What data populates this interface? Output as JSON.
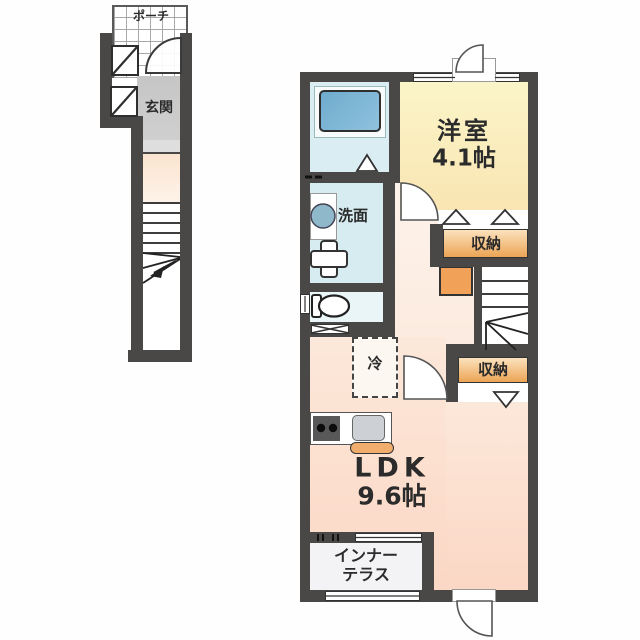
{
  "title": "apartment floor plan",
  "labels": {
    "porch": "ポーチ",
    "entrance": "玄関",
    "western_room": "洋室",
    "western_room_size": "4.1帖",
    "storage_upper": "収納",
    "storage_lower": "収納",
    "washroom": "洗面",
    "fridge": "冷",
    "ldk": "LDK",
    "ldk_size": "9.6帖",
    "terrace_line1": "インナー",
    "terrace_line2": "テラス"
  },
  "colors": {
    "wall": "#4a4846",
    "bath": "#d9edf2",
    "tub": "#7cb5d7",
    "yellow": "#fbf5c8",
    "yellow2": "#f9e5b2",
    "cream": "#fdf3ea",
    "cream2": "#fbe7d8",
    "pink": "#fce8da",
    "pink2": "#fbd7c5",
    "orange": "#eca455",
    "orange_light": "#fbe2bd",
    "accent": "#f1a258",
    "genkan": "#c9c9c9",
    "terrace": "#f3f3f6"
  }
}
